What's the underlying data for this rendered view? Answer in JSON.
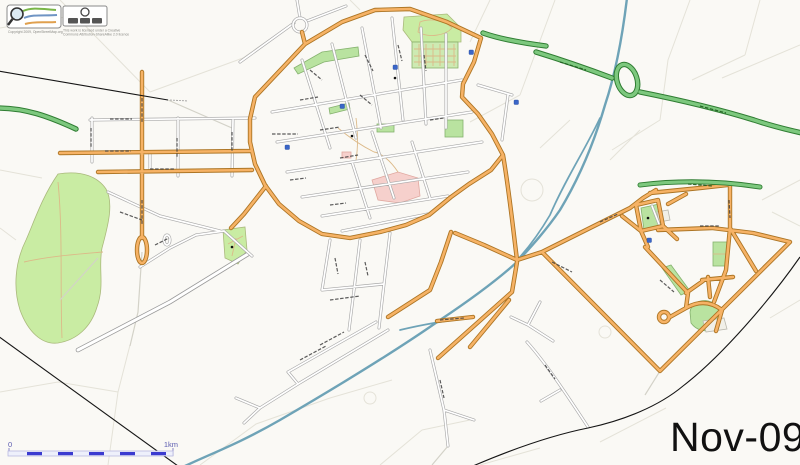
{
  "map_export": {
    "date_label": "Nov-09",
    "scale_bar": {
      "start_label": "0",
      "end_label": "1km"
    },
    "attribution": {
      "osm_caption": "Copyright 2009, OpenStreetMap.org",
      "cc_caption_line1": "This work is licensed under a Creative",
      "cc_caption_line2": "Commons Attribution-ShareAlike 2.0 licence"
    }
  },
  "colors": {
    "background": "#faf9f5",
    "road-orange-fill": "#f6b265",
    "road-orange-casing": "#ad7524",
    "road-white-fill": "#ffffff",
    "road-white-casing": "#a8a8a8",
    "trunk-fill": "#7dc87e",
    "trunk-casing": "#2f7d32",
    "water": "#6ea3b7",
    "park": "#c9eca3",
    "cemetery": "#cdeab2",
    "hospital": "#f6d0cc",
    "railway": "#151515",
    "scalebar-blue": "#3b3bd0",
    "label-dark": "#3f3f3f"
  }
}
